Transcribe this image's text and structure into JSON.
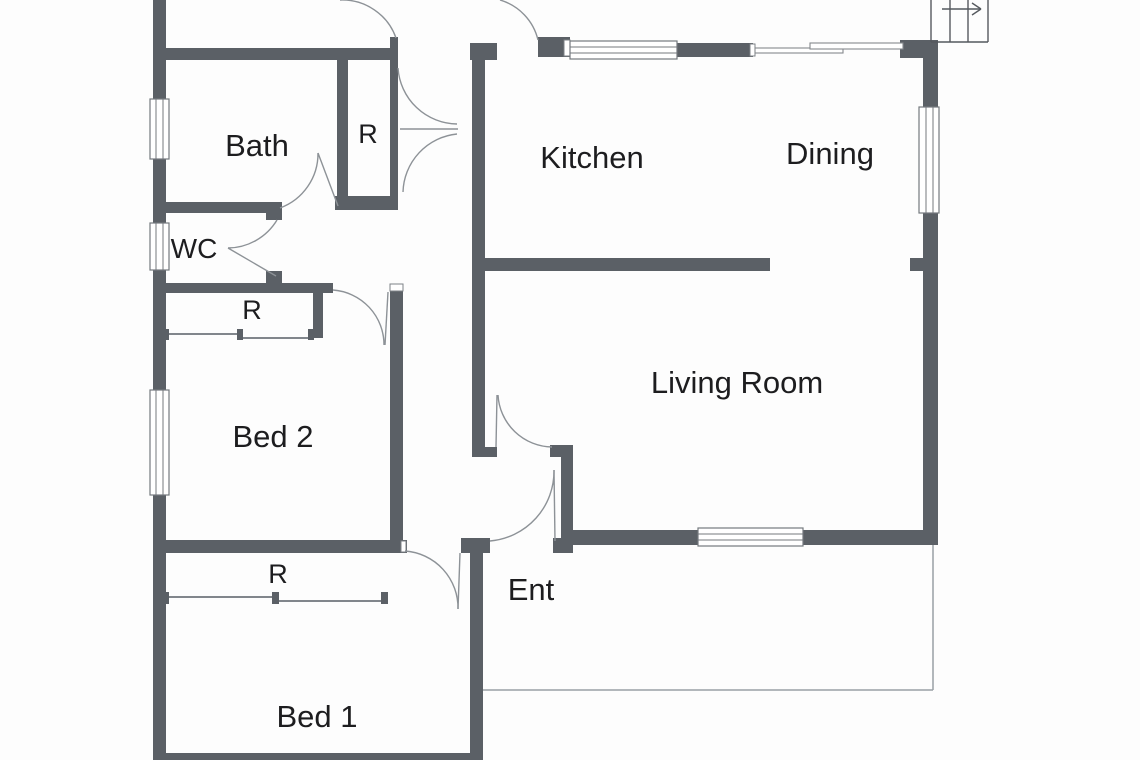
{
  "floorplan": {
    "title": "Single storey floor plan",
    "colors": {
      "wall": "#5b6066",
      "background": "#fdfdfd",
      "text": "#1d1d1f",
      "door_line": "#8d9297",
      "patio_line": "#9aa0a5"
    },
    "rooms": {
      "bath": {
        "label": "Bath"
      },
      "robe_bath": {
        "label": "R"
      },
      "wc": {
        "label": "WC"
      },
      "robe_bed2": {
        "label": "R"
      },
      "bed2": {
        "label": "Bed 2"
      },
      "robe_bed1": {
        "label": "R"
      },
      "bed1": {
        "label": "Bed 1"
      },
      "kitchen": {
        "label": "Kitchen"
      },
      "dining": {
        "label": "Dining"
      },
      "living": {
        "label": "Living Room"
      },
      "entry": {
        "label": "Ent"
      }
    }
  }
}
